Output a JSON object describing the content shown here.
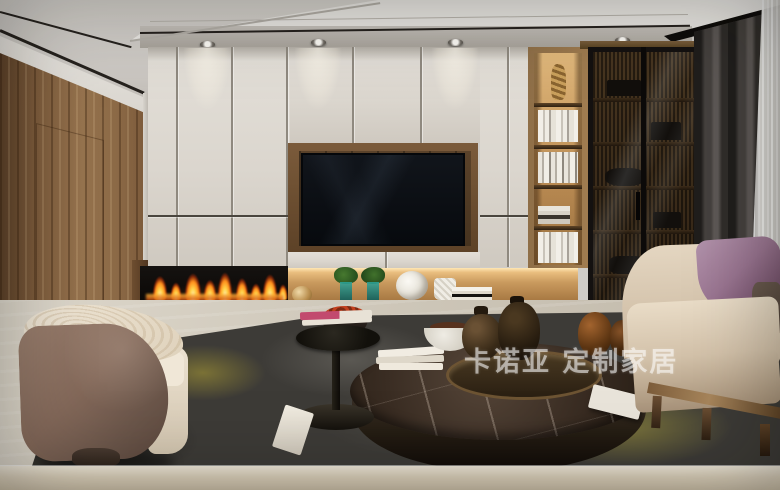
{
  "watermark": {
    "text": "卡诺亚 定制家居"
  },
  "scene": {
    "description": "Modern living room render: cream wall-to-wall TV cabinetry with linear fireplace, open wooden bookshelf, smoked-glass display cabinet, gray curtains, beige sofa with purple pillow, barrel armchair, round marble coffee table on dark rug",
    "objects": [
      "ceiling-downlights",
      "wood-panel-wall",
      "cream-cabinet-wall",
      "tv-screen",
      "linear-fireplace",
      "lit-display-shelf",
      "open-bookshelf",
      "glass-display-cabinet",
      "gray-curtain",
      "sheer-curtain",
      "beige-sofa",
      "purple-pillow",
      "barrel-armchair",
      "round-marble-coffee-table",
      "black-side-table",
      "area-rug"
    ],
    "palette": {
      "cabinet_cream": "#dcd7cf",
      "wood": "#8a6747",
      "tv_black": "#0d1116",
      "flame_orange": "#ff8e1c",
      "shelf_glow": "#ffe7b4",
      "curtain_gray": "#45413e",
      "sofa_beige": "#d9cab4",
      "pillow_purple": "#9a7591",
      "rug_charcoal": "#3d3b37",
      "rug_yellow": "#b6aa3e",
      "floor_travertine": "#cdc6b8",
      "marble_table": "#41332a"
    }
  }
}
